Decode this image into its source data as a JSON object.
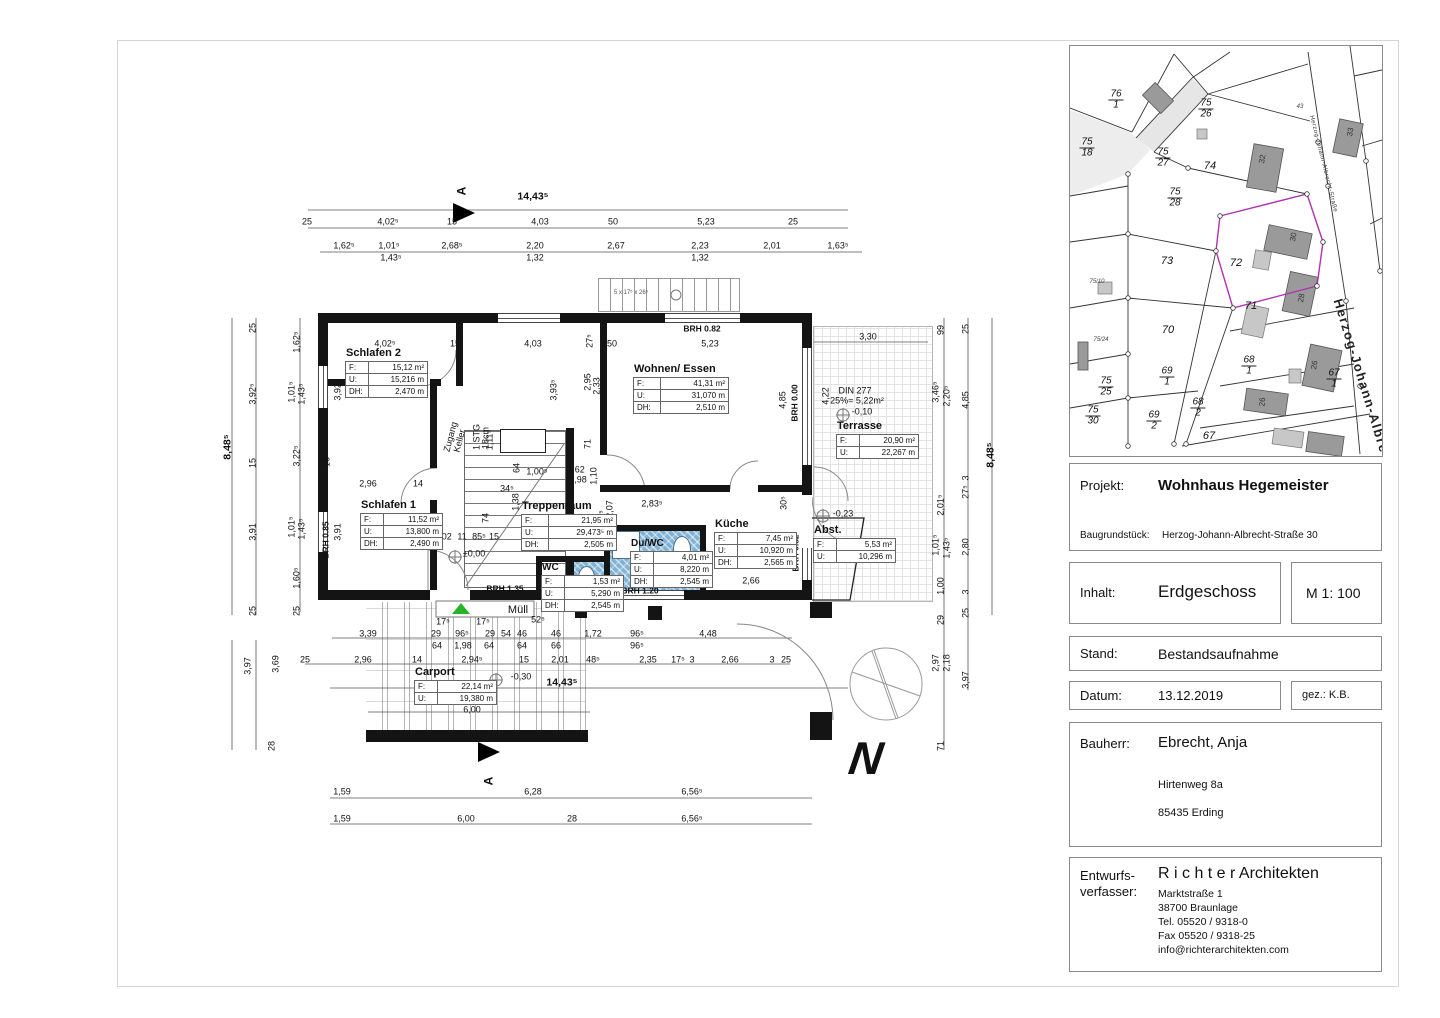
{
  "title_block": {
    "projekt_label": "Projekt:",
    "projekt_value": "Wohnhaus Hegemeister",
    "baugrundstueck_label": "Baugrundstück:",
    "baugrundstueck_value": "Herzog-Johann-Albrecht-Straße 30",
    "inhalt_label": "Inhalt:",
    "inhalt_value": "Erdgeschoss",
    "massstab": "M 1: 100",
    "stand_label": "Stand:",
    "stand_value": "Bestandsaufnahme",
    "datum_label": "Datum:",
    "datum_value": "13.12.2019",
    "gez": "gez.: K.B.",
    "bauherr_label": "Bauherr:",
    "bauherr_value": "Ebrecht, Anja",
    "bauherr_addr1": "Hirtenweg 8a",
    "bauherr_addr2": "85435 Erding",
    "entwurf_label1": "Entwurfs-",
    "entwurf_label2": "verfasser:",
    "firm_name": "R i c h t e r Architekten",
    "firm_addr": [
      "Marktstraße 1",
      "38700 Braunlage",
      "Tel. 05520 / 9318-0",
      "Fax 05520 / 9318-25",
      "info@richterarchitekten.com"
    ]
  },
  "floor_plan": {
    "north": "N",
    "section_letter": "A",
    "labels": {
      "f": "F:",
      "u": "U:",
      "dh": "DH:"
    },
    "rooms": {
      "schlafen2": {
        "name": "Schlafen 2",
        "f": "15,12 m²",
        "u": "15,216 m",
        "dh": "2,470 m"
      },
      "schlafen1": {
        "name": "Schlafen 1",
        "f": "11,52 m²",
        "u": "13,800 m",
        "dh": "2,490 m"
      },
      "wohnen": {
        "name": "Wohnen/ Essen",
        "f": "41,31 m²",
        "u": "31,070 m",
        "dh": "2,510 m"
      },
      "treppenraum": {
        "name": "Treppenraum",
        "f": "21,95 m²",
        "u": "29,473⁵ m",
        "dh": "2,505 m"
      },
      "kueche": {
        "name": "Küche",
        "f": "7,45 m²",
        "u": "10,920 m",
        "dh": "2,565 m"
      },
      "duwc": {
        "name": "Du/WC",
        "f": "4,01 m²",
        "u": "8,220 m",
        "dh": "2,545 m"
      },
      "wc": {
        "name": "WC",
        "f": "1,53 m²",
        "u": "5,290 m",
        "dh": "2,545 m"
      },
      "abst": {
        "name": "Abst.",
        "f": "5,53 m²",
        "u": "10,296 m"
      },
      "terrasse": {
        "name": "Terrasse",
        "f": "20,90 m²",
        "u": "22,267 m"
      },
      "carport": {
        "name": "Carport",
        "f": "22,14 m²",
        "u": "19,380 m"
      }
    },
    "dims": [
      {
        "t": "14,43⁵",
        "x": 533,
        "y": 197,
        "c": "b"
      },
      {
        "t": "25",
        "x": 307,
        "y": 222
      },
      {
        "t": "4,02⁵",
        "x": 388,
        "y": 222
      },
      {
        "t": "15",
        "x": 452,
        "y": 222
      },
      {
        "t": "4,03",
        "x": 540,
        "y": 222
      },
      {
        "t": "50",
        "x": 613,
        "y": 222
      },
      {
        "t": "5,23",
        "x": 706,
        "y": 222
      },
      {
        "t": "25",
        "x": 793,
        "y": 222
      },
      {
        "t": "1,62⁵",
        "x": 344,
        "y": 246
      },
      {
        "t": "1,01⁵",
        "x": 389,
        "y": 246
      },
      {
        "t": "1,43⁵",
        "x": 391,
        "y": 258
      },
      {
        "t": "2,68⁵",
        "x": 452,
        "y": 246
      },
      {
        "t": "2,20",
        "x": 535,
        "y": 246
      },
      {
        "t": "1,32",
        "x": 535,
        "y": 258
      },
      {
        "t": "2,67",
        "x": 616,
        "y": 246
      },
      {
        "t": "2,23",
        "x": 700,
        "y": 246
      },
      {
        "t": "1,32",
        "x": 700,
        "y": 258
      },
      {
        "t": "2,01",
        "x": 772,
        "y": 246
      },
      {
        "t": "1,63⁵",
        "x": 838,
        "y": 246
      },
      {
        "t": "4,02⁵",
        "x": 385,
        "y": 344
      },
      {
        "t": "15",
        "x": 455,
        "y": 344
      },
      {
        "t": "4,03",
        "x": 533,
        "y": 344
      },
      {
        "t": "50",
        "x": 612,
        "y": 344
      },
      {
        "t": "5,23",
        "x": 710,
        "y": 344
      },
      {
        "t": "3,30",
        "x": 868,
        "y": 337
      },
      {
        "t": "27⁵",
        "x": 590,
        "y": 341,
        "r": -90
      },
      {
        "t": "3,92⁵",
        "x": 338,
        "y": 390,
        "r": -90
      },
      {
        "t": "16",
        "x": 327,
        "y": 462,
        "r": -90
      },
      {
        "t": "3,91",
        "x": 338,
        "y": 532,
        "r": -90
      },
      {
        "t": "3,93⁵",
        "x": 554,
        "y": 390,
        "r": -90
      },
      {
        "t": "2,95",
        "x": 588,
        "y": 382,
        "r": -90
      },
      {
        "t": "2,33",
        "x": 597,
        "y": 386,
        "r": -90
      },
      {
        "t": "71",
        "x": 588,
        "y": 444,
        "r": -90
      },
      {
        "t": "4,85",
        "x": 783,
        "y": 400,
        "r": -90
      },
      {
        "t": "4,22",
        "x": 826,
        "y": 396,
        "r": -90
      },
      {
        "t": "2,96",
        "x": 368,
        "y": 484
      },
      {
        "t": "14",
        "x": 418,
        "y": 484
      },
      {
        "t": "1,00⁵",
        "x": 537,
        "y": 472
      },
      {
        "t": "1,62",
        "x": 576,
        "y": 470
      },
      {
        "t": "1,98",
        "x": 578,
        "y": 480
      },
      {
        "t": "1,10",
        "x": 594,
        "y": 476,
        "r": -90
      },
      {
        "t": "64",
        "x": 517,
        "y": 468,
        "r": -90
      },
      {
        "t": "34⁵",
        "x": 507,
        "y": 489
      },
      {
        "t": "1,38",
        "x": 516,
        "y": 502,
        "r": -90
      },
      {
        "t": "1,11⁵",
        "x": 490,
        "y": 440,
        "r": -90
      },
      {
        "t": "74",
        "x": 486,
        "y": 518,
        "r": -90
      },
      {
        "t": "95⁵",
        "x": 602,
        "y": 517,
        "r": -90
      },
      {
        "t": "2,07",
        "x": 610,
        "y": 509,
        "r": -90
      },
      {
        "t": "1,02",
        "x": 443,
        "y": 537
      },
      {
        "t": "11",
        "x": 462,
        "y": 537
      },
      {
        "t": "85⁵",
        "x": 479,
        "y": 537
      },
      {
        "t": "15",
        "x": 494,
        "y": 537
      },
      {
        "t": "2,83⁵",
        "x": 652,
        "y": 504
      },
      {
        "t": "30⁵",
        "x": 784,
        "y": 503,
        "r": -90
      },
      {
        "t": "2,66",
        "x": 751,
        "y": 581
      },
      {
        "t": "2,80",
        "x": 786,
        "y": 549,
        "r": -90
      },
      {
        "t": "8,48⁵",
        "x": 228,
        "y": 447,
        "r": -90,
        "c": "b"
      },
      {
        "t": "3,97",
        "x": 248,
        "y": 666,
        "r": -90
      },
      {
        "t": "25",
        "x": 253,
        "y": 328,
        "r": -90
      },
      {
        "t": "3,92⁵",
        "x": 253,
        "y": 394,
        "r": -90
      },
      {
        "t": "15",
        "x": 253,
        "y": 463,
        "r": -90
      },
      {
        "t": "3,91",
        "x": 253,
        "y": 532,
        "r": -90
      },
      {
        "t": "25",
        "x": 253,
        "y": 611,
        "r": -90
      },
      {
        "t": "3,69",
        "x": 276,
        "y": 664,
        "r": -90
      },
      {
        "t": "28",
        "x": 272,
        "y": 746,
        "r": -90
      },
      {
        "t": "1,62⁵",
        "x": 297,
        "y": 342,
        "r": -90
      },
      {
        "t": "1,01⁵",
        "x": 292,
        "y": 392,
        "r": -90
      },
      {
        "t": "1,43⁵",
        "x": 302,
        "y": 394,
        "r": -90
      },
      {
        "t": "3,22⁵",
        "x": 297,
        "y": 456,
        "r": -90
      },
      {
        "t": "1,01⁵",
        "x": 292,
        "y": 527,
        "r": -90
      },
      {
        "t": "1,43⁵",
        "x": 302,
        "y": 529,
        "r": -90
      },
      {
        "t": "1,60⁵",
        "x": 297,
        "y": 578,
        "r": -90
      },
      {
        "t": "25",
        "x": 297,
        "y": 611,
        "r": -90
      },
      {
        "t": "99",
        "x": 941,
        "y": 330,
        "r": -90
      },
      {
        "t": "3,46⁵",
        "x": 936,
        "y": 392,
        "r": -90
      },
      {
        "t": "2,20⁵",
        "x": 947,
        "y": 396,
        "r": -90
      },
      {
        "t": "2,01⁵",
        "x": 941,
        "y": 505,
        "r": -90
      },
      {
        "t": "1,01⁵",
        "x": 936,
        "y": 545,
        "r": -90
      },
      {
        "t": "1,43⁵",
        "x": 947,
        "y": 548,
        "r": -90
      },
      {
        "t": "1,00",
        "x": 941,
        "y": 586,
        "r": -90
      },
      {
        "t": "29",
        "x": 941,
        "y": 620,
        "r": -90
      },
      {
        "t": "2,97",
        "x": 936,
        "y": 663,
        "r": -90
      },
      {
        "t": "2,18",
        "x": 947,
        "y": 663,
        "r": -90
      },
      {
        "t": "71",
        "x": 941,
        "y": 746,
        "r": -90
      },
      {
        "t": "25",
        "x": 966,
        "y": 329,
        "r": -90
      },
      {
        "t": "4,85",
        "x": 966,
        "y": 400,
        "r": -90
      },
      {
        "t": "3",
        "x": 966,
        "y": 478,
        "r": -90
      },
      {
        "t": "27⁵",
        "x": 966,
        "y": 492,
        "r": -90
      },
      {
        "t": "2,80",
        "x": 966,
        "y": 547,
        "r": -90
      },
      {
        "t": "3",
        "x": 966,
        "y": 592,
        "r": -90
      },
      {
        "t": "25",
        "x": 966,
        "y": 613,
        "r": -90
      },
      {
        "t": "3,97",
        "x": 966,
        "y": 680,
        "r": -90
      },
      {
        "t": "8,48⁵",
        "x": 991,
        "y": 455,
        "r": -90,
        "c": "b"
      },
      {
        "t": "17⁵",
        "x": 443,
        "y": 622
      },
      {
        "t": "17⁵",
        "x": 483,
        "y": 622
      },
      {
        "t": "52⁵",
        "x": 538,
        "y": 620
      },
      {
        "t": "3,39",
        "x": 368,
        "y": 634
      },
      {
        "t": "29",
        "x": 436,
        "y": 634
      },
      {
        "t": "96⁵",
        "x": 462,
        "y": 634
      },
      {
        "t": "29",
        "x": 490,
        "y": 634
      },
      {
        "t": "54",
        "x": 506,
        "y": 634
      },
      {
        "t": "46",
        "x": 522,
        "y": 634
      },
      {
        "t": "46",
        "x": 556,
        "y": 634
      },
      {
        "t": "1,72",
        "x": 593,
        "y": 634
      },
      {
        "t": "96⁵",
        "x": 637,
        "y": 634
      },
      {
        "t": "4,48",
        "x": 708,
        "y": 634
      },
      {
        "t": "64",
        "x": 437,
        "y": 646
      },
      {
        "t": "1,98",
        "x": 463,
        "y": 646
      },
      {
        "t": "64",
        "x": 489,
        "y": 646
      },
      {
        "t": "64",
        "x": 522,
        "y": 646
      },
      {
        "t": "66",
        "x": 556,
        "y": 646
      },
      {
        "t": "96⁵",
        "x": 637,
        "y": 646
      },
      {
        "t": "25",
        "x": 305,
        "y": 660
      },
      {
        "t": "2,96",
        "x": 363,
        "y": 660
      },
      {
        "t": "14",
        "x": 417,
        "y": 660
      },
      {
        "t": "2,94⁵",
        "x": 472,
        "y": 660
      },
      {
        "t": "15",
        "x": 524,
        "y": 660
      },
      {
        "t": "2,01",
        "x": 560,
        "y": 660
      },
      {
        "t": "48⁵",
        "x": 593,
        "y": 660
      },
      {
        "t": "2,35",
        "x": 648,
        "y": 660
      },
      {
        "t": "17⁵",
        "x": 678,
        "y": 660
      },
      {
        "t": "3",
        "x": 692,
        "y": 660
      },
      {
        "t": "2,66",
        "x": 730,
        "y": 660
      },
      {
        "t": "3",
        "x": 772,
        "y": 660
      },
      {
        "t": "25",
        "x": 786,
        "y": 660
      },
      {
        "t": "14,43⁵",
        "x": 562,
        "y": 683,
        "c": "b"
      },
      {
        "t": "6,00",
        "x": 472,
        "y": 710
      },
      {
        "t": "1,59",
        "x": 342,
        "y": 792
      },
      {
        "t": "6,28",
        "x": 533,
        "y": 792
      },
      {
        "t": "6,56⁵",
        "x": 692,
        "y": 792
      },
      {
        "t": "1,59",
        "x": 342,
        "y": 819
      },
      {
        "t": "6,00",
        "x": 466,
        "y": 819
      },
      {
        "t": "28",
        "x": 572,
        "y": 819
      },
      {
        "t": "6,56⁵",
        "x": 692,
        "y": 819
      },
      {
        "t": "BRH 0.82",
        "x": 702,
        "y": 329,
        "c": "ann"
      },
      {
        "t": "BRH 0.00",
        "x": 795,
        "y": 403,
        "r": -90,
        "c": "ann"
      },
      {
        "t": "BRH 0.85",
        "x": 326,
        "y": 540,
        "r": -90,
        "c": "ann"
      },
      {
        "t": "BRH 1.35",
        "x": 505,
        "y": 589,
        "c": "ann"
      },
      {
        "t": "BRH 1.20",
        "x": 640,
        "y": 591,
        "c": "ann"
      },
      {
        "t": "BRH 0.82",
        "x": 796,
        "y": 553,
        "r": -90,
        "c": "ann"
      },
      {
        "t": "±0,00",
        "x": 474,
        "y": 554
      },
      {
        "t": "-0,10",
        "x": 862,
        "y": 412
      },
      {
        "t": "DIN 277",
        "x": 855,
        "y": 391
      },
      {
        "t": "25%= 5,22m²",
        "x": 857,
        "y": 401
      },
      {
        "t": "-0,23",
        "x": 843,
        "y": 514
      },
      {
        "t": "-0,30",
        "x": 521,
        "y": 677
      },
      {
        "t": "Müll",
        "x": 518,
        "y": 611,
        "c": "big"
      },
      {
        "t": "Kamin",
        "x": 523,
        "y": 441,
        "c": "kb"
      },
      {
        "t": "Zugang",
        "x": 451,
        "y": 437,
        "r": -75
      },
      {
        "t": "Keller",
        "x": 460,
        "y": 441,
        "r": -75
      },
      {
        "t": "1 STG",
        "x": 477,
        "y": 437,
        "r": -90
      },
      {
        "t": "18cm",
        "x": 486,
        "y": 438,
        "r": -90
      },
      {
        "t": "5 x 17⁵ x 26⁵",
        "x": 631,
        "y": 293,
        "c": "sm"
      },
      {
        "t": "A",
        "x": 462,
        "y": 191,
        "r": -90,
        "c": "sec"
      },
      {
        "t": "A",
        "x": 489,
        "y": 781,
        "r": -90,
        "c": "sec"
      }
    ]
  },
  "site_plan": {
    "street_small": "Herzog-Johann-Albrecht-Straße",
    "street_big": "Herzog-Johann-Albre",
    "highlight_color": "#b330b3",
    "labels": [
      {
        "t": "76",
        "t2": "1",
        "x": 46,
        "y": 54
      },
      {
        "t": "75",
        "t2": "26",
        "x": 136,
        "y": 63
      },
      {
        "t": "75",
        "t2": "18",
        "x": 17,
        "y": 102
      },
      {
        "t": "75",
        "t2": "27",
        "x": 93,
        "y": 112
      },
      {
        "t": "75",
        "t2": "28",
        "x": 105,
        "y": 152
      },
      {
        "t": "68",
        "t2": "1",
        "x": 179,
        "y": 320
      },
      {
        "t": "69",
        "t2": "1",
        "x": 97,
        "y": 331
      },
      {
        "t": "75",
        "t2": "25",
        "x": 36,
        "y": 341
      },
      {
        "t": "75",
        "t2": "30",
        "x": 23,
        "y": 370
      },
      {
        "t": "69",
        "t2": "2",
        "x": 84,
        "y": 375
      },
      {
        "t": "68",
        "t2": "2",
        "x": 128,
        "y": 362
      },
      {
        "t": "67",
        "t2": "1",
        "x": 264,
        "y": 333
      },
      {
        "t": "74",
        "x": 140,
        "y": 121,
        "c": "pl"
      },
      {
        "t": "73",
        "x": 97,
        "y": 216,
        "c": "pl"
      },
      {
        "t": "72",
        "x": 166,
        "y": 218,
        "c": "pl"
      },
      {
        "t": "71",
        "x": 181,
        "y": 261,
        "c": "pl"
      },
      {
        "t": "70",
        "x": 98,
        "y": 285,
        "c": "pl"
      },
      {
        "t": "67",
        "x": 139,
        "y": 391,
        "c": "pl"
      },
      {
        "t": "43",
        "x": 230,
        "y": 61,
        "c": "tiny"
      },
      {
        "t": "75/10",
        "x": 27,
        "y": 236,
        "c": "tiny"
      },
      {
        "t": "75/24",
        "x": 31,
        "y": 294,
        "c": "tiny"
      },
      {
        "t": "32",
        "x": 193,
        "y": 113,
        "r": -80,
        "c": "bn"
      },
      {
        "t": "33",
        "x": 281,
        "y": 86,
        "r": -80,
        "c": "bn"
      },
      {
        "t": "30",
        "x": 224,
        "y": 191,
        "r": -80,
        "c": "bn"
      },
      {
        "t": "28",
        "x": 232,
        "y": 252,
        "r": -80,
        "c": "bn"
      },
      {
        "t": "26",
        "x": 245,
        "y": 319,
        "r": -80,
        "c": "bn"
      },
      {
        "t": "26",
        "x": 193,
        "y": 356,
        "r": -85,
        "c": "bn"
      },
      {
        "t": "Herzog-Johann-Albrecht-Straße",
        "x": 253,
        "y": 118,
        "r": 76,
        "c": "st-sm"
      },
      {
        "t": "Herzog-Johann-Albre",
        "x": 291,
        "y": 330,
        "r": 73,
        "c": "st-bg"
      }
    ]
  }
}
